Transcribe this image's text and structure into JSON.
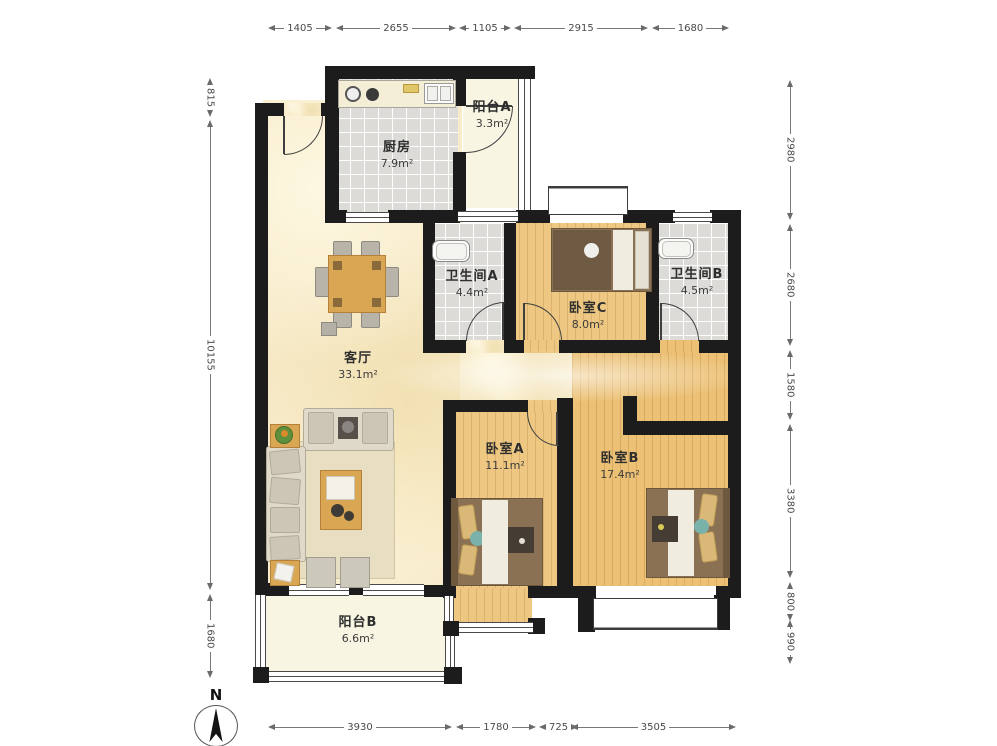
{
  "plan": {
    "north_label": "N",
    "rooms": [
      {
        "id": "kitchen",
        "name": "厨房",
        "area": "7.9m²"
      },
      {
        "id": "balcony_a",
        "name": "阳台A",
        "area": "3.3m²"
      },
      {
        "id": "bath_a",
        "name": "卫生间A",
        "area": "4.4m²"
      },
      {
        "id": "bedroom_c",
        "name": "卧室C",
        "area": "8.0m²"
      },
      {
        "id": "bath_b",
        "name": "卫生间B",
        "area": "4.5m²"
      },
      {
        "id": "living",
        "name": "客厅",
        "area": "33.1m²"
      },
      {
        "id": "bedroom_a",
        "name": "卧室A",
        "area": "11.1m²"
      },
      {
        "id": "bedroom_b",
        "name": "卧室B",
        "area": "17.4m²"
      },
      {
        "id": "balcony_b",
        "name": "阳台B",
        "area": "6.6m²"
      }
    ],
    "dimensions": {
      "top": [
        "1405",
        "2655",
        "1105",
        "2915",
        "1680"
      ],
      "left": [
        "815",
        "10155",
        "1680"
      ],
      "right": [
        "2980",
        "2680",
        "1580",
        "3380",
        "800",
        "990"
      ],
      "bottom": [
        "3930",
        "1780",
        "725",
        "3505"
      ]
    },
    "colors": {
      "wall": "#1c1c1c",
      "wood_floor": "#eec883",
      "tile_floor": "#dcdbd8",
      "living_floor": "#f6e9c6",
      "balcony_floor": "#f8f5e2",
      "dimension_text": "#4a4a4a"
    }
  }
}
